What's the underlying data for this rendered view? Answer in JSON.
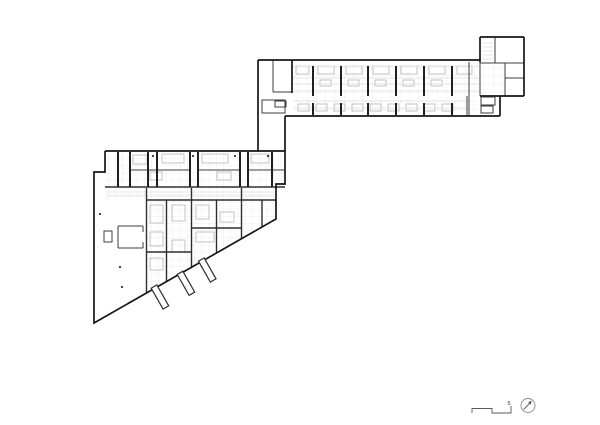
{
  "document": {
    "type": "architectural-floor-plan",
    "background": "#ffffff"
  },
  "annotations": {
    "scale_label": "5"
  },
  "colors": {
    "thick": "#161616",
    "wall": "#1f1f1f",
    "wall2": "#2e2e2e",
    "medium": "#3c3c3c",
    "light": "#b5b5b5",
    "faint": "#dcdcdc",
    "note": "#5a5a5a",
    "ring": "#8a8a8a",
    "pattern": "#e9e9e9",
    "dot": "#333333",
    "text": "#333333"
  },
  "canvas": {
    "width": 600,
    "height": 425
  },
  "geometry": {
    "style_widths": {
      "thick": 1.7,
      "wall": 2.0,
      "wall2": 1.4,
      "medium": 1.0,
      "light": 0.8,
      "faint": 0.7,
      "note": 0.9
    },
    "patterns": [
      {
        "id": "gA",
        "w": 9.3,
        "h": 8.4
      },
      {
        "id": "gB",
        "w": 7.2,
        "h": 7.2
      }
    ],
    "pattern_areas": [
      {
        "pat": "gA",
        "pts": [
          [
            293,
            63
          ],
          [
            479,
            63
          ],
          [
            479,
            113
          ],
          [
            293,
            113
          ]
        ]
      },
      {
        "pat": "gA",
        "pts": [
          [
            481,
            64
          ],
          [
            504,
            64
          ],
          [
            504,
            95
          ],
          [
            481,
            95
          ]
        ]
      },
      {
        "pat": "gB",
        "pts": [
          [
            106,
            152
          ],
          [
            284,
            152
          ],
          [
            284,
            186
          ],
          [
            106,
            186
          ]
        ]
      },
      {
        "pat": "gB",
        "pts": [
          [
            106,
            188
          ],
          [
            145,
            188
          ],
          [
            145,
            200
          ],
          [
            106,
            200
          ]
        ]
      },
      {
        "pat": "gB",
        "pts": [
          [
            145,
            188
          ],
          [
            276,
            188
          ],
          [
            276,
            218
          ],
          [
            146,
            292
          ]
        ]
      }
    ],
    "lines": {
      "thick": [
        [
          258,
          60,
          480,
          60
        ],
        [
          258,
          60,
          258,
          151
        ],
        [
          285,
          116,
          285,
          151
        ],
        [
          285,
          116,
          500,
          116
        ],
        [
          500,
          96,
          500,
          116
        ],
        [
          480,
          96,
          524,
          96
        ],
        [
          524,
          37,
          524,
          96
        ],
        [
          480,
          37,
          524,
          37
        ],
        [
          480,
          37,
          480,
          62
        ],
        [
          292,
          60,
          292,
          93
        ]
      ],
      "wall": [
        [
          313,
          66,
          313,
          96
        ],
        [
          341,
          66,
          341,
          96
        ],
        [
          368,
          66,
          368,
          96
        ],
        [
          396,
          66,
          396,
          96
        ],
        [
          424,
          66,
          424,
          96
        ],
        [
          452,
          66,
          452,
          96
        ],
        [
          313,
          103,
          313,
          115
        ],
        [
          341,
          103,
          341,
          115
        ],
        [
          368,
          103,
          368,
          115
        ],
        [
          396,
          103,
          396,
          115
        ],
        [
          424,
          103,
          424,
          115
        ],
        [
          452,
          103,
          452,
          115
        ],
        [
          118,
          152,
          118,
          187
        ],
        [
          130,
          152,
          130,
          187
        ],
        [
          148,
          152,
          148,
          187
        ],
        [
          157,
          152,
          157,
          187
        ],
        [
          190,
          152,
          190,
          187
        ],
        [
          198,
          152,
          198,
          187
        ],
        [
          240,
          152,
          240,
          187
        ],
        [
          248,
          152,
          248,
          187
        ],
        [
          272,
          152,
          272,
          187
        ]
      ],
      "wall2": [
        [
          146.5,
          188,
          146.5,
          293
        ],
        [
          166.5,
          200,
          166.5,
          282
        ],
        [
          191.5,
          188,
          191.5,
          267
        ],
        [
          216.5,
          200,
          216.5,
          253
        ],
        [
          241.5,
          188,
          241.5,
          239
        ],
        [
          262,
          200,
          262,
          227
        ],
        [
          191.5,
          228,
          241.5,
          228
        ],
        [
          146.5,
          252,
          191.5,
          252
        ],
        [
          146,
          200,
          276,
          200
        ],
        [
          105,
          187,
          285,
          187
        ]
      ],
      "medium": [
        [
          273,
          60,
          273,
          92
        ],
        [
          273,
          92,
          292,
          92
        ],
        [
          469,
          62,
          469,
          116
        ],
        [
          480,
          60,
          480,
          96
        ],
        [
          480,
          63,
          524,
          63
        ],
        [
          495,
          37,
          495,
          63
        ],
        [
          505,
          63,
          505,
          96
        ],
        [
          505,
          78,
          524,
          78
        ],
        [
          467,
          96,
          467,
          116
        ],
        [
          130,
          170,
          190,
          170
        ],
        [
          198,
          170,
          240,
          170
        ],
        [
          248,
          170,
          284,
          170
        ],
        [
          118,
          226,
          143,
          226
        ],
        [
          118,
          226,
          118,
          248
        ],
        [
          118,
          248,
          143,
          248
        ],
        [
          143,
          226,
          143,
          232
        ],
        [
          143,
          242,
          143,
          248
        ]
      ],
      "faint": [
        [
          293,
          66,
          479,
          66
        ],
        [
          293,
          78,
          479,
          78
        ],
        [
          293,
          84,
          479,
          84
        ],
        [
          293,
          91,
          479,
          91
        ],
        [
          293,
          101,
          467,
          101
        ],
        [
          293,
          108,
          467,
          108
        ],
        [
          482,
          43,
          493,
          43
        ],
        [
          482,
          47,
          493,
          47
        ],
        [
          482,
          51,
          493,
          51
        ],
        [
          482,
          55,
          493,
          55
        ],
        [
          482,
          59,
          493,
          59
        ],
        [
          106,
          192,
          276,
          192
        ],
        [
          106,
          196,
          276,
          196
        ]
      ],
      "note": [
        [
          523.5,
          409.5,
          530.5,
          402.5
        ]
      ]
    },
    "polylines": {
      "thick": [
        [
          [
            105,
            151
          ],
          [
            285,
            151
          ],
          [
            285,
            184
          ],
          [
            276,
            184
          ],
          [
            276,
            219
          ],
          [
            94,
            323
          ],
          [
            94,
            172
          ],
          [
            105,
            172
          ],
          [
            105,
            151
          ]
        ]
      ],
      "note": [
        [
          [
            472,
            413
          ],
          [
            472,
            408.5
          ],
          [
            492,
            408.5
          ],
          [
            492,
            413
          ],
          [
            511,
            413
          ],
          [
            511,
            406
          ]
        ]
      ]
    },
    "rects": {
      "medium": [
        [
          262,
          100,
          23,
          13
        ],
        [
          275,
          101,
          11,
          6
        ],
        [
          481,
          97,
          14,
          8
        ],
        [
          481,
          106,
          12,
          7
        ],
        [
          104,
          231,
          8,
          11
        ]
      ],
      "light": [
        [
          296,
          66,
          13,
          8
        ],
        [
          318,
          66,
          16,
          8
        ],
        [
          346,
          66,
          16,
          8
        ],
        [
          373,
          66,
          16,
          8
        ],
        [
          401,
          66,
          16,
          8
        ],
        [
          429,
          66,
          16,
          8
        ],
        [
          457,
          66,
          15,
          8
        ],
        [
          320,
          80,
          11,
          6
        ],
        [
          348,
          80,
          11,
          6
        ],
        [
          375,
          80,
          11,
          6
        ],
        [
          403,
          80,
          11,
          6
        ],
        [
          431,
          80,
          11,
          6
        ],
        [
          298,
          104,
          11,
          7
        ],
        [
          316,
          104,
          11,
          7
        ],
        [
          334,
          104,
          11,
          7
        ],
        [
          352,
          104,
          11,
          7
        ],
        [
          370,
          104,
          11,
          7
        ],
        [
          388,
          104,
          11,
          7
        ],
        [
          406,
          104,
          11,
          7
        ],
        [
          424,
          104,
          11,
          7
        ],
        [
          442,
          104,
          11,
          7
        ],
        [
          133,
          155,
          14,
          9
        ],
        [
          162,
          154,
          22,
          9
        ],
        [
          202,
          154,
          26,
          9
        ],
        [
          251,
          154,
          18,
          9
        ],
        [
          150,
          172,
          12,
          8
        ],
        [
          217,
          172,
          14,
          8
        ],
        [
          150,
          205,
          13,
          18
        ],
        [
          172,
          205,
          13,
          16
        ],
        [
          196,
          205,
          13,
          14
        ],
        [
          150,
          232,
          13,
          14
        ],
        [
          196,
          232,
          18,
          10
        ],
        [
          220,
          212,
          14,
          10
        ],
        [
          150,
          258,
          13,
          12
        ],
        [
          172,
          240,
          13,
          12
        ]
      ]
    },
    "fins": {
      "angle": 60.3,
      "len": 24,
      "w": 6.5,
      "starts": [
        [
          155,
          288.3
        ],
        [
          181,
          274.6
        ],
        [
          202.3,
          261.3
        ]
      ]
    },
    "dots": [
      [
        100,
        214
      ],
      [
        120,
        267
      ],
      [
        122,
        287
      ],
      [
        130,
        156
      ],
      [
        153,
        156
      ],
      [
        193,
        156
      ],
      [
        235,
        156
      ],
      [
        268,
        156
      ]
    ],
    "north": {
      "cx": 528,
      "cy": 405.5,
      "r": 7,
      "head": [
        [
          531.8,
          400.6
        ],
        [
          528.2,
          402.2
        ],
        [
          530.6,
          404.9
        ]
      ]
    },
    "texts": [
      {
        "x": 507.5,
        "y": 405,
        "bind": "annotations.scale_label",
        "size": 5.5
      }
    ]
  }
}
